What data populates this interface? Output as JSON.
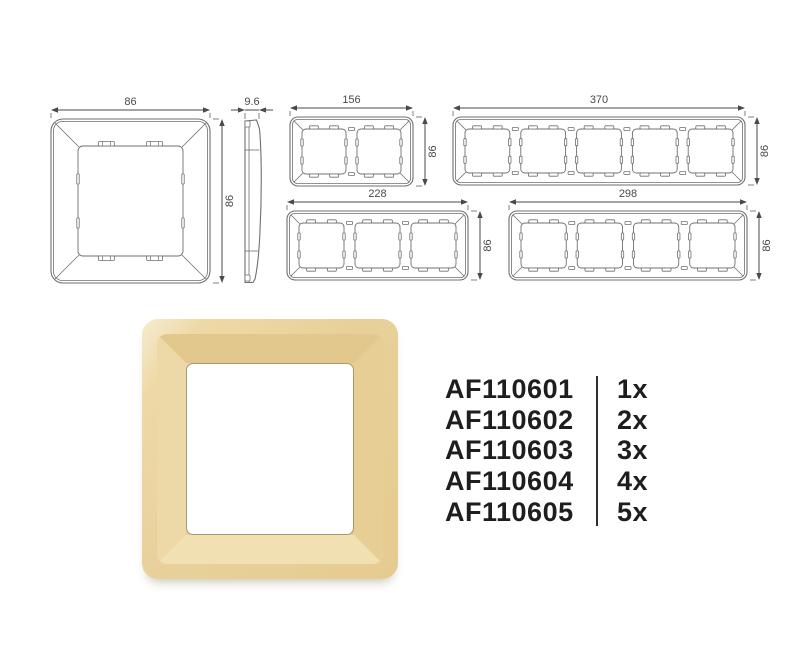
{
  "drawings": {
    "colors": {
      "line": "#6f6f6f",
      "dimension_text": "#4a4a4a"
    },
    "views": [
      {
        "id": "front-1gang",
        "type": "front",
        "gangs": 1,
        "width_label": "86",
        "height_label": "86"
      },
      {
        "id": "side-profile",
        "type": "side",
        "width_label": "9.6"
      },
      {
        "id": "front-2gang",
        "type": "front",
        "gangs": 2,
        "width_label": "156",
        "height_label": "86"
      },
      {
        "id": "front-5gang",
        "type": "front",
        "gangs": 5,
        "width_label": "370",
        "height_label": "86"
      },
      {
        "id": "front-3gang",
        "type": "front",
        "gangs": 3,
        "width_label": "228",
        "height_label": "86"
      },
      {
        "id": "front-4gang",
        "type": "front",
        "gangs": 4,
        "width_label": "298",
        "height_label": "86"
      }
    ]
  },
  "product_image": {
    "colors": {
      "base": "#e9d19c",
      "highlight": "#f6ecd0",
      "shadow": "#e2c88c",
      "opening": "#ffffff"
    }
  },
  "product_list": {
    "divider_color": "#2e2e2e",
    "items": [
      {
        "code": "AF110601",
        "qty": "1x"
      },
      {
        "code": "AF110602",
        "qty": "2x"
      },
      {
        "code": "AF110603",
        "qty": "3x"
      },
      {
        "code": "AF110604",
        "qty": "4x"
      },
      {
        "code": "AF110605",
        "qty": "5x"
      }
    ]
  }
}
